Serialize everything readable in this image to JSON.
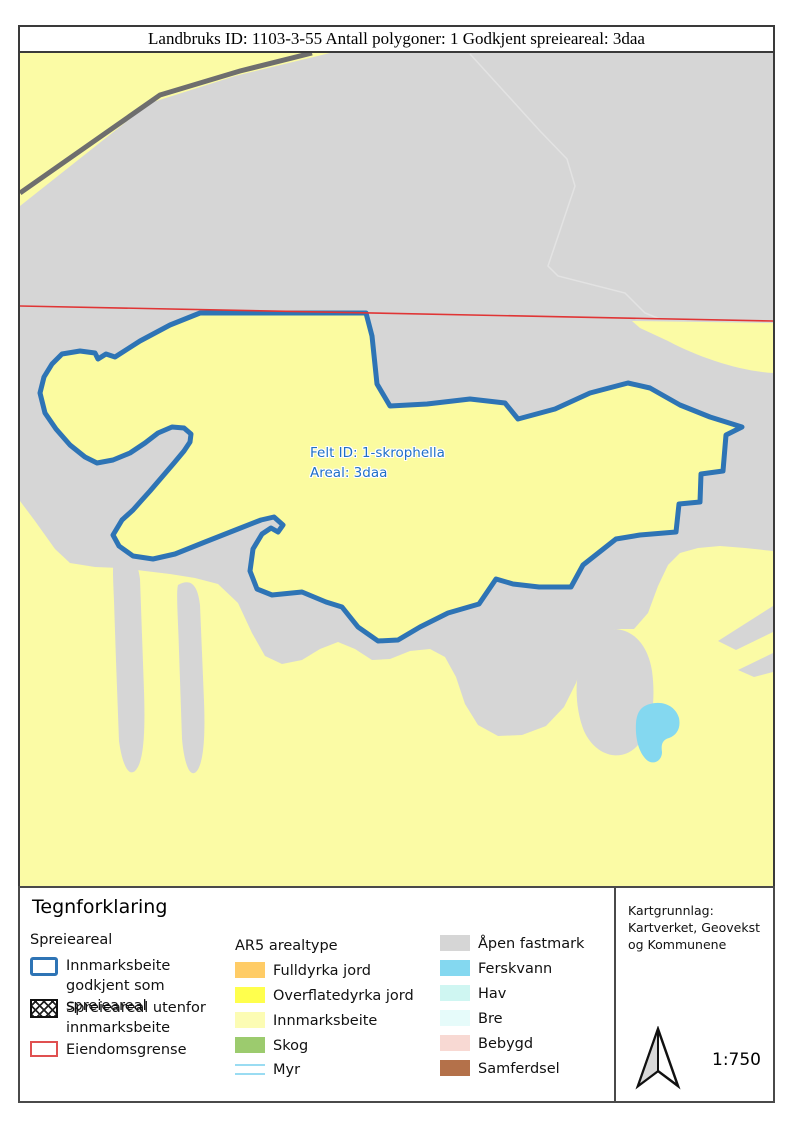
{
  "title_bar": {
    "text": "Landbruks ID: 1103-3-55 Antall polygoner: 1 Godkjent spreieareal: 3daa"
  },
  "map": {
    "feature_label": {
      "line1": "Felt ID: 1-skrophella",
      "line2": "Areal: 3daa"
    },
    "colors": {
      "open_ground": "#d6d6d6",
      "pasture_yellow": "#fbfba5",
      "polygon_fill": "#fbfba0",
      "polygon_stroke": "#2e74b5",
      "road_gray": "#6e6e6e",
      "boundary_red": "#e03535",
      "water_blue": "#84d8f0",
      "faint_path": "#e3e3e3",
      "label_blue": "#1f6fc8"
    }
  },
  "legend": {
    "title": "Tegnforklaring",
    "spreieareal": {
      "heading": "Spreieareal",
      "items": [
        {
          "label": "Innmarksbeite godkjent som spreieareal",
          "swatch": "blue-outline-swatch",
          "color": "#2e74b5"
        },
        {
          "label": "Spreieareal utenfor innmarksbeite",
          "swatch": "crosshatch-swatch",
          "color": "#111111"
        },
        {
          "label": "Eiendomsgrense",
          "swatch": "red-outline-swatch",
          "color": "#e05050"
        }
      ]
    },
    "ar5": {
      "heading": "AR5 arealtype",
      "items": [
        {
          "label": "Fulldyrka jord",
          "color": "#ffcc66"
        },
        {
          "label": "Overflatedyrka jord",
          "color": "#ffff4d"
        },
        {
          "label": "Innmarksbeite",
          "color": "#fcfcb4"
        },
        {
          "label": "Skog",
          "color": "#9ccb6e"
        },
        {
          "label": "Myr",
          "color": "#9adcf2"
        }
      ]
    },
    "ar5_right": {
      "items": [
        {
          "label": "Åpen fastmark",
          "color": "#d6d6d6"
        },
        {
          "label": "Ferskvann",
          "color": "#84d8f0"
        },
        {
          "label": "Hav",
          "color": "#cff6f2"
        },
        {
          "label": "Bre",
          "color": "#e6fbfa"
        },
        {
          "label": "Bebygd",
          "color": "#f8d9d3"
        },
        {
          "label": "Samferdsel",
          "color": "#b4714a"
        }
      ]
    }
  },
  "info_box": {
    "line1": "Kartgrunnlag:",
    "line2": "Kartverket, Geovekst",
    "line3": "og Kommunene",
    "scale": "1:750"
  }
}
